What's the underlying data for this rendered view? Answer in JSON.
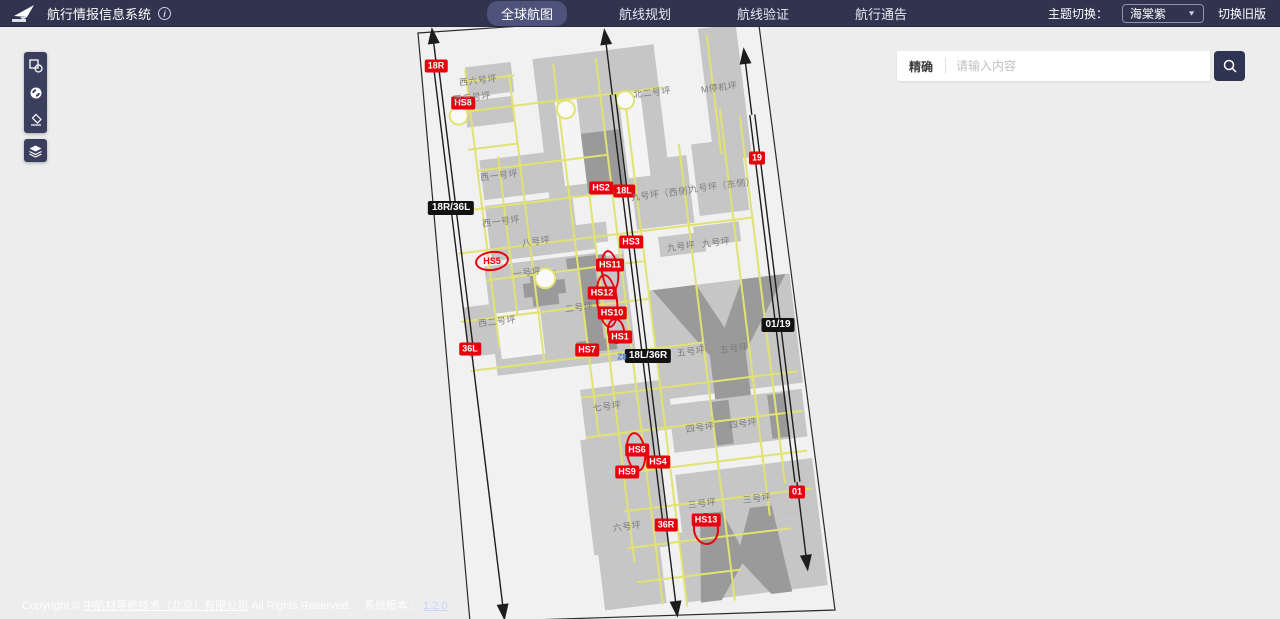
{
  "navbar": {
    "title": "航行情报信息系统",
    "items": [
      {
        "label": "全球航图",
        "active": true
      },
      {
        "label": "航线规划",
        "active": false
      },
      {
        "label": "航线验证",
        "active": false
      },
      {
        "label": "航行通告",
        "active": false
      }
    ],
    "theme_label": "主题切换：",
    "theme_value": "海棠紫",
    "legacy_link": "切换旧版"
  },
  "toolbar": {
    "icons": [
      "draw-shapes",
      "locate",
      "eraser",
      "layers"
    ]
  },
  "search": {
    "mode_label": "精确",
    "placeholder": "请输入内容"
  },
  "footer": {
    "copyright_prefix": "Copyright © ",
    "company": "中航材导航技术（北京）有限公司",
    "copyright_suffix": " All Rights Reserved.",
    "version_label": "系统版本：",
    "version": "1.2.0"
  },
  "map": {
    "colors": {
      "navbar_bg": "#30344f",
      "accent_red": "#e8000d",
      "designator_black": "#121212",
      "taxiway_yellow": "#e2e272",
      "apron_gray": "#c6c6c6",
      "building_gray": "#9a9a9a",
      "map_bg": "#ededed"
    },
    "runway_labels": [
      {
        "text": "18R",
        "x": 436,
        "y": 66
      },
      {
        "text": "HS8",
        "x": 463,
        "y": 103
      },
      {
        "text": "19",
        "x": 757,
        "y": 158
      },
      {
        "text": "HS2",
        "x": 601,
        "y": 188
      },
      {
        "text": "18L",
        "x": 624,
        "y": 191
      },
      {
        "text": "HS3",
        "x": 631,
        "y": 242
      },
      {
        "text": "HS11",
        "x": 610,
        "y": 265
      },
      {
        "text": "HS12",
        "x": 602,
        "y": 293
      },
      {
        "text": "HS10",
        "x": 612,
        "y": 313
      },
      {
        "text": "HS1",
        "x": 620,
        "y": 337
      },
      {
        "text": "36L",
        "x": 470,
        "y": 349
      },
      {
        "text": "HS7",
        "x": 587,
        "y": 350
      },
      {
        "text": "HS6",
        "x": 637,
        "y": 450
      },
      {
        "text": "HS4",
        "x": 658,
        "y": 462
      },
      {
        "text": "HS9",
        "x": 627,
        "y": 472
      },
      {
        "text": "HS13",
        "x": 706,
        "y": 520
      },
      {
        "text": "36R",
        "x": 666,
        "y": 525
      },
      {
        "text": "01",
        "x": 797,
        "y": 492
      }
    ],
    "red_text_labels": [
      {
        "text": "HS5",
        "x": 492,
        "y": 261
      }
    ],
    "designator_labels": [
      {
        "text": "18R/36L",
        "x": 451,
        "y": 208
      },
      {
        "text": "18L/36R",
        "x": 648,
        "y": 356
      },
      {
        "text": "01/19",
        "x": 778,
        "y": 325
      }
    ],
    "taxiway_labels": [
      {
        "text": "Z8",
        "x": 622,
        "y": 357
      }
    ],
    "apron_labels": [
      {
        "text": "西六号坪",
        "x": 478,
        "y": 80
      },
      {
        "text": "西五号坪",
        "x": 472,
        "y": 97
      },
      {
        "text": "北二号坪",
        "x": 652,
        "y": 92
      },
      {
        "text": "M停机坪",
        "x": 719,
        "y": 87
      },
      {
        "text": "西一号坪",
        "x": 499,
        "y": 175
      },
      {
        "text": "九号坪（西侧）",
        "x": 664,
        "y": 193
      },
      {
        "text": "九号坪（东侧）",
        "x": 722,
        "y": 185
      },
      {
        "text": "西一号坪",
        "x": 501,
        "y": 221
      },
      {
        "text": "八号坪",
        "x": 536,
        "y": 241
      },
      {
        "text": "九号坪",
        "x": 681,
        "y": 246
      },
      {
        "text": "九号坪",
        "x": 716,
        "y": 242
      },
      {
        "text": "一号坪",
        "x": 527,
        "y": 272
      },
      {
        "text": "二号坪",
        "x": 579,
        "y": 307
      },
      {
        "text": "西二号坪",
        "x": 497,
        "y": 321
      },
      {
        "text": "五号坪",
        "x": 691,
        "y": 351
      },
      {
        "text": "五号坪",
        "x": 734,
        "y": 348
      },
      {
        "text": "七号坪",
        "x": 607,
        "y": 406
      },
      {
        "text": "四号坪",
        "x": 700,
        "y": 427
      },
      {
        "text": "四号坪",
        "x": 743,
        "y": 423
      },
      {
        "text": "六号坪",
        "x": 627,
        "y": 526
      },
      {
        "text": "三号坪",
        "x": 702,
        "y": 503
      },
      {
        "text": "三号坪",
        "x": 757,
        "y": 498
      }
    ],
    "hotspot_ellipses": [
      {
        "x": 492,
        "y": 261,
        "rx": 17,
        "ry": 10
      },
      {
        "x": 610,
        "y": 271,
        "rx": 9,
        "ry": 21
      },
      {
        "x": 607,
        "y": 301,
        "rx": 11,
        "ry": 27
      },
      {
        "x": 616,
        "y": 331,
        "rx": 9,
        "ry": 13
      },
      {
        "x": 636,
        "y": 452,
        "rx": 10,
        "ry": 20
      },
      {
        "x": 706,
        "y": 529,
        "rx": 13,
        "ry": 16
      }
    ]
  }
}
